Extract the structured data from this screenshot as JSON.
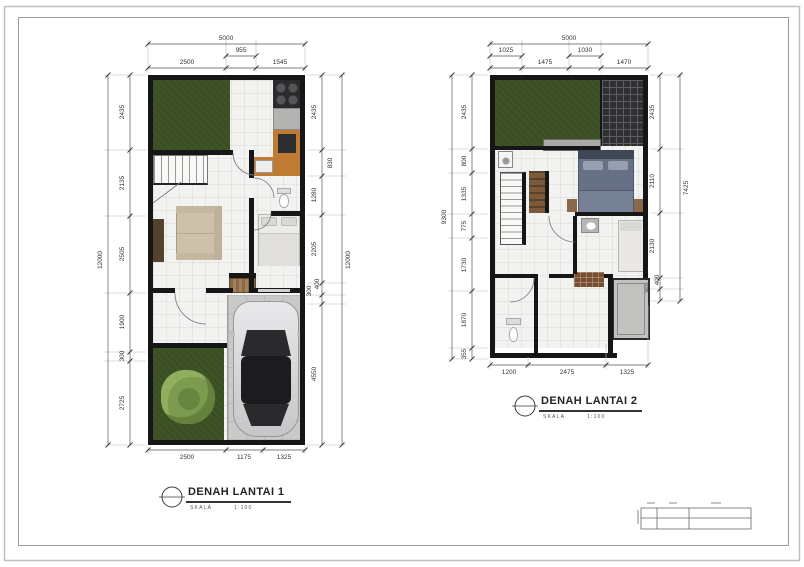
{
  "plan1": {
    "title": "DENAH LANTAI 1",
    "scale_label": "SKALA",
    "scale_value": "1:100",
    "dims": {
      "top_total": "5000",
      "top_mid": [
        "955"
      ],
      "top_row": [
        "2500",
        "1545"
      ],
      "bottom_row": [
        "2500",
        "1175",
        "1325"
      ],
      "left_total": "12000",
      "left_col": [
        "2435",
        "2135",
        "2505",
        "1900",
        "300",
        "2725"
      ],
      "right_total": "12000",
      "right_col": [
        "2435",
        "830",
        "1280",
        "2205",
        "300",
        "400",
        "4550"
      ]
    }
  },
  "plan2": {
    "title": "DENAH LANTAI 2",
    "scale_label": "SKALA",
    "scale_value": "1:100",
    "dims": {
      "top_total": "5000",
      "top_mid": [
        "1025",
        "1030"
      ],
      "top_row": [
        "1475",
        "1470"
      ],
      "bottom_row": [
        "1200",
        "2475",
        "1325"
      ],
      "left_total": "9300",
      "left_col": [
        "2435",
        "800",
        "1335",
        "775",
        "1730",
        "1870",
        "355"
      ],
      "right_total": "7425",
      "right_col": [
        "2435",
        "2110",
        "2130",
        "350",
        "400"
      ]
    }
  },
  "colors": {
    "wall": "#161616",
    "grass": "#3f5426",
    "tree": "#7c9b4f",
    "floor": "#f2f2f0",
    "carport": "#c9c9c7",
    "kitchen_orange": "#bf7a33",
    "car_silver": "#d9d9db",
    "bed_gray_blue": "#677185",
    "roof_dark": "#303032",
    "balcony_gray": "#c2c2c0",
    "dim_line": "#555555",
    "dim_text": "#333333"
  }
}
